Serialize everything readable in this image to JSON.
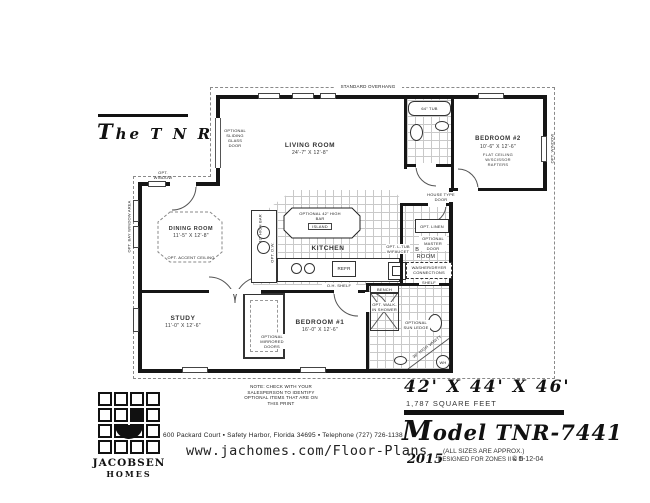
{
  "title": "The T N R",
  "plan": {
    "overhang": "STANDARD OVERHANG",
    "rooms": {
      "living": {
        "name": "LIVING ROOM",
        "dims": "24'-7\" X 12'-8\""
      },
      "bedroom2": {
        "name": "BEDROOM #2",
        "dims": "10'-6\" X 12'-6\"",
        "note": "FLAT CEILING W/SCISSOR RAFTERS"
      },
      "dining": {
        "name": "DINING ROOM",
        "dims": "11'-5\" X 12'-8\"",
        "note": "OPT. ACCENT CEILING"
      },
      "kitchen": {
        "name": "KITCHEN"
      },
      "bonus": {
        "name": "BONUS ROOM"
      },
      "study": {
        "name": "STUDY",
        "dims": "11'-0\" X 12'-6\""
      },
      "bedroom1": {
        "name": "BEDROOM #1",
        "dims": "16'-0\" X 12'-6\""
      }
    },
    "labels": {
      "opt_window": "OPT. WINDOW",
      "sliding_door": "OPTIONAL SLIDING GLASS DOOR",
      "bay_window": "OPT. BAY WINDOW AREA",
      "high_bar": "42\" HIGH BAR",
      "island_bar": "OPTIONAL 42\" HIGH BAR",
      "island": "ISLAND",
      "opt_dw": "OPT. D.W.",
      "refr": "REFR",
      "oh_shelf": "O.H. SHELF",
      "tub": "64\" TUB",
      "house_door": "HOUSE TYPE DOOR",
      "linen": "OPT. LINEN",
      "master_door": "OPTIONAL MASTER DOOR",
      "laundry_tub": "OPT. L-TUB W/FAUCET",
      "wd": "WASHER/DRYER CONNECTIONS",
      "shelf": "SHELF",
      "bench": "BENCH",
      "shower": "OPT. WALK-IN SHOWER",
      "sun_ledge": "OPTIONAL SUN LEDGE",
      "vanity": "36\" HIGH VANITY",
      "wh": "WH",
      "mirrored": "OPTIONAL MIRRORED DOORS"
    },
    "note": "NOTE: CHECK WITH YOUR SALESPERSON TO IDENTIFY OPTIONAL ITEMS THAT ARE ON THIS PRINT"
  },
  "footer": {
    "brand": {
      "name1": "JACOBSEN",
      "name2": "HOMES"
    },
    "address": "600 Packard Court ▪ Safety Harbor, Florida 34695 ▪ Telephone (727) 726-1138",
    "website": "www.jachomes.com/Floor-Plans",
    "sizes": "42' X 44' X 46'",
    "sqft": "1,787 SQUARE FEET",
    "model": "Model TNR-7441",
    "approx": "(ALL SIZES ARE APPROX.)",
    "year": "2015",
    "zones": "DESIGNED FOR ZONES II & III",
    "copyright": "© 5-12-04"
  }
}
